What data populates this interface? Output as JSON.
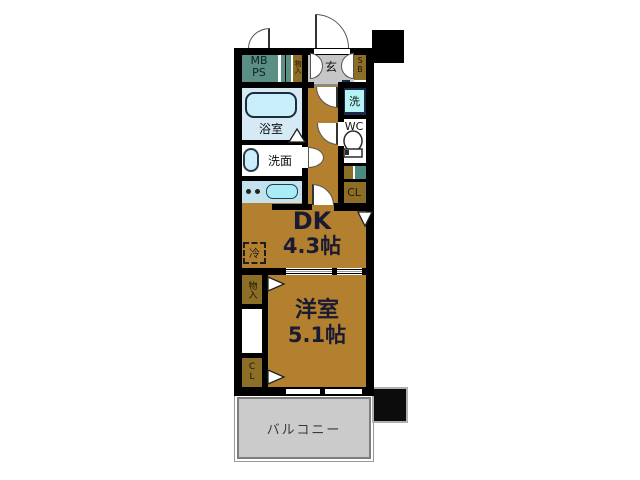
{
  "floorplan": {
    "title": "apartment-floor-plan",
    "labels": {
      "mb_ps": "MB\nPS",
      "storage_top": "物入",
      "entrance": "玄",
      "shoe_box": "SB",
      "washer": "洗",
      "toilet": "WC",
      "bath": "浴室",
      "washstand": "洗面",
      "closet_dk": "CL",
      "dk_name": "DK",
      "dk_size": "4.3帖",
      "fridge": "冷",
      "storage_left": "物入",
      "closet_left": "CL",
      "western_room_name": "洋室",
      "western_room_size": "5.1帖",
      "balcony": "バルコニー"
    },
    "colors": {
      "wall": "#000000",
      "wood_floor": "#b2802f",
      "teal_unit": "#5b8e85",
      "olive_closet": "#8d6e26",
      "entrance_gray": "#c6c6c6",
      "balcony_gray": "#cbcbcb",
      "bath_bg": "#d6eaf5",
      "fixture_cyan": "#c9f0fa",
      "kitchen_counter": "#c3e2f0",
      "washer_fill": "#b5f2f4"
    }
  }
}
